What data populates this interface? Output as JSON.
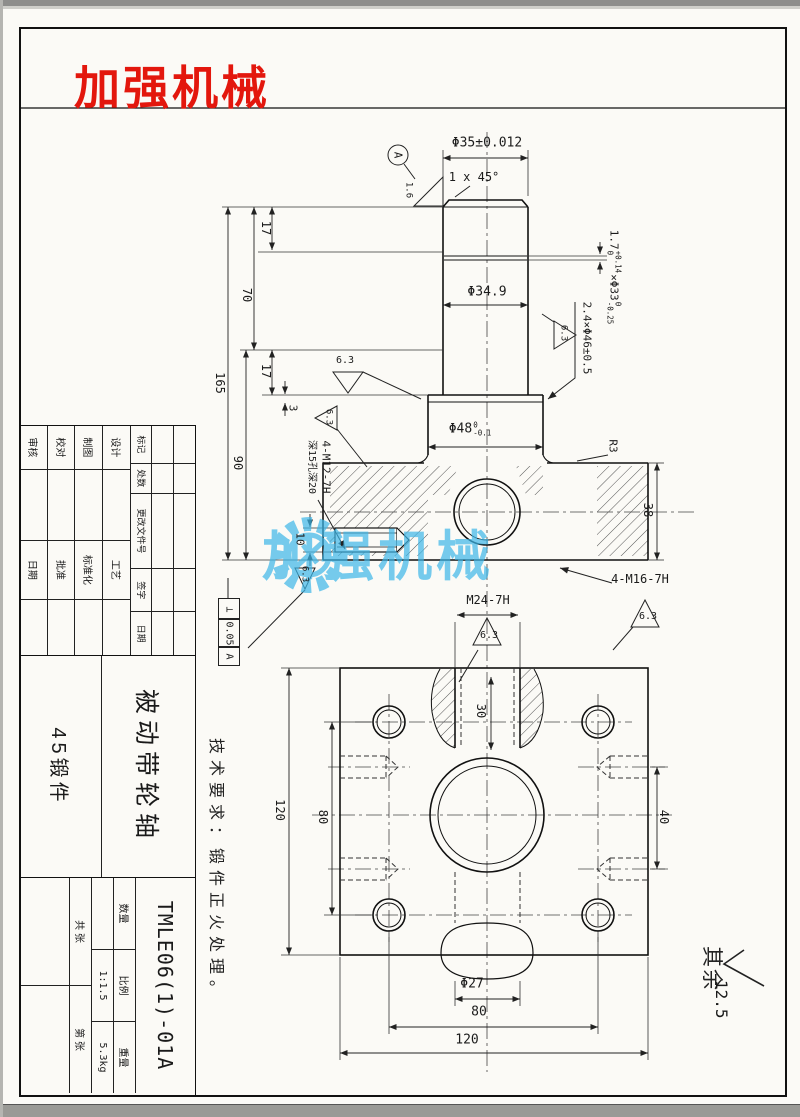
{
  "page": {
    "logo": "加强机械",
    "watermark": "加强机械",
    "colors": {
      "logo_red": "#e3170d",
      "watermark_blue": "#3db7e8"
    }
  },
  "front": {
    "dia35": "Φ35±0.012",
    "chamfer": "1 x 45°",
    "datum_a": "A",
    "ra_16": "1.6",
    "d17a": "17",
    "d70": "70",
    "d165": "165",
    "d17b": "17",
    "d3": "3",
    "d90": "90",
    "d10": "10",
    "dia349": "Φ34.9",
    "groove33": {
      "pre": "1.7",
      "pre_sup": "+0.14",
      "pre_sub": "0",
      "main": "×Φ33",
      "sup": "0",
      "sub": "-0.25"
    },
    "groove46": "2.4×Φ46±0.5",
    "dia48": {
      "main": "Φ48",
      "sup": "0",
      "sub": "-0.1"
    },
    "r3": "R3",
    "d38": "38",
    "m16": "4-M16-7H",
    "m12": "4-M12-7H",
    "m12_depth": "深15孔深20",
    "ra_63": "6.3",
    "tol": {
      "sym": "⊥",
      "val": "0.05",
      "datum": "A"
    }
  },
  "plan": {
    "m24": "M24-7H",
    "d30": "30",
    "d80v": "80",
    "d120v": "120",
    "d40": "40",
    "dia27": "Φ27",
    "d80h": "80",
    "d120h": "120"
  },
  "notes": {
    "tech": "技术要求：锻件正火处理。",
    "rest_label": "其余",
    "rest_value": "12.5"
  },
  "title": {
    "rev": [
      "标记",
      "处数",
      "更改文件号",
      "签字",
      "日期"
    ],
    "roles": [
      "设计",
      "制图",
      "校对",
      "审核"
    ],
    "roles2": [
      "工艺",
      "标准化",
      "批准",
      "日期"
    ],
    "part_name": "被动带轮轴",
    "material": "45锻件",
    "drawing_no": "TMLE06(1)-01A",
    "qty_label": "数量",
    "qty_value": "",
    "scale_label": "比例",
    "scale_value": "1:1.5",
    "weight_label": "重量",
    "weight_value": "5.3kg",
    "sheet_total": "共 张",
    "sheet_no": "第 张"
  }
}
